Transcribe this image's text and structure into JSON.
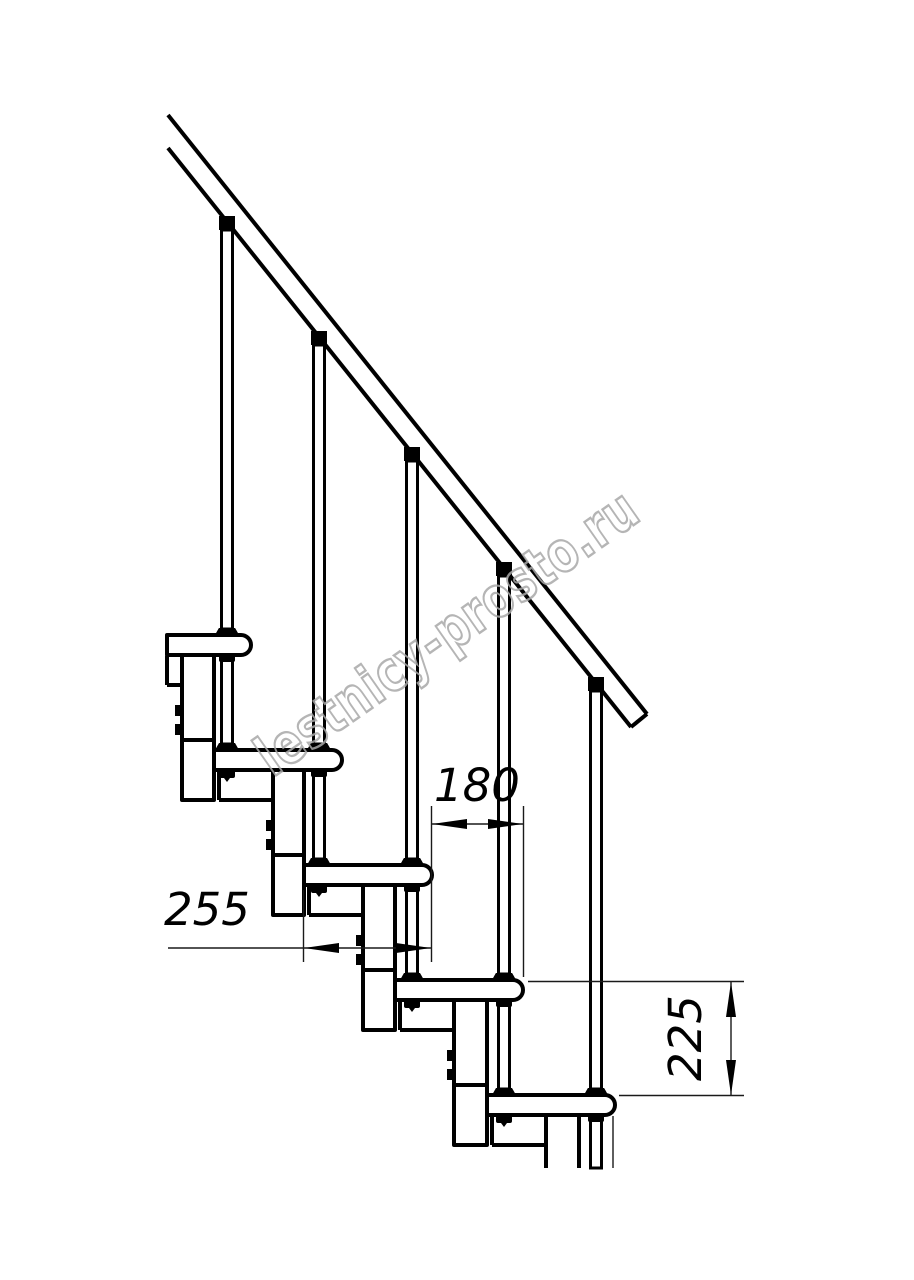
{
  "drawing": {
    "title": "staircase-side-elevation",
    "line_color": "#000000",
    "background_color": "#ffffff",
    "steps_visible": 5,
    "balusters_visible": 5,
    "has_handrail": true
  },
  "dimensions": {
    "run": {
      "value": "180",
      "orientation": "horizontal"
    },
    "tread_depth": {
      "value": "255",
      "orientation": "horizontal"
    },
    "riser": {
      "value": "225",
      "orientation": "vertical"
    }
  },
  "watermark": {
    "text": "lestnicy-prosto.ru",
    "color": "#a9a9a9"
  }
}
